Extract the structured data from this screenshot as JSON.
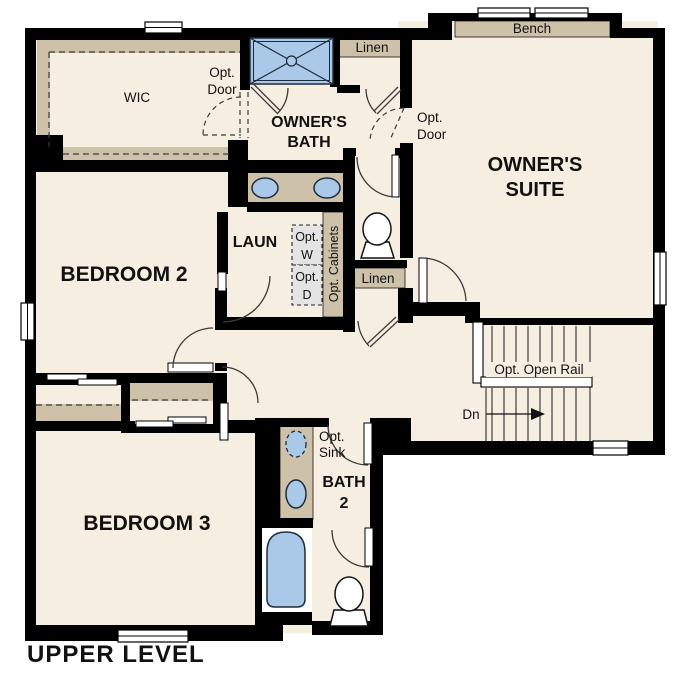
{
  "title": "UPPER LEVEL",
  "colors": {
    "floor": "#f6eee1",
    "wall": "#000000",
    "shelf_tan": "#cec1a9",
    "fixture_blue": "#aac9e8",
    "appliance_gray": "#e4e4e4",
    "door_line": "#3a3a3a",
    "text": "#111111"
  },
  "rooms": {
    "wic": "WIC",
    "owners_bath_line1": "OWNER'S",
    "owners_bath_line2": "BATH",
    "owners_suite_line1": "OWNER'S",
    "owners_suite_line2": "SUITE",
    "bedroom2": "BEDROOM 2",
    "laundry": "LAUN",
    "bedroom3": "BEDROOM 3",
    "bath2_line1": "BATH",
    "bath2_line2": "2"
  },
  "labels": {
    "bench": "Bench",
    "linen_top": "Linen",
    "linen_hall": "Linen",
    "opt_door_wic_line1": "Opt.",
    "opt_door_wic_line2": "Door",
    "opt_door_suite_line1": "Opt.",
    "opt_door_suite_line2": "Door",
    "opt_w_line1": "Opt.",
    "opt_w_line2": "W",
    "opt_d_line1": "Opt.",
    "opt_d_line2": "D",
    "opt_cabinets": "Opt. Cabinets",
    "opt_open_rail": "Opt. Open Rail",
    "down": "Dn",
    "opt_sink_line1": "Opt.",
    "opt_sink_line2": "Sink"
  }
}
